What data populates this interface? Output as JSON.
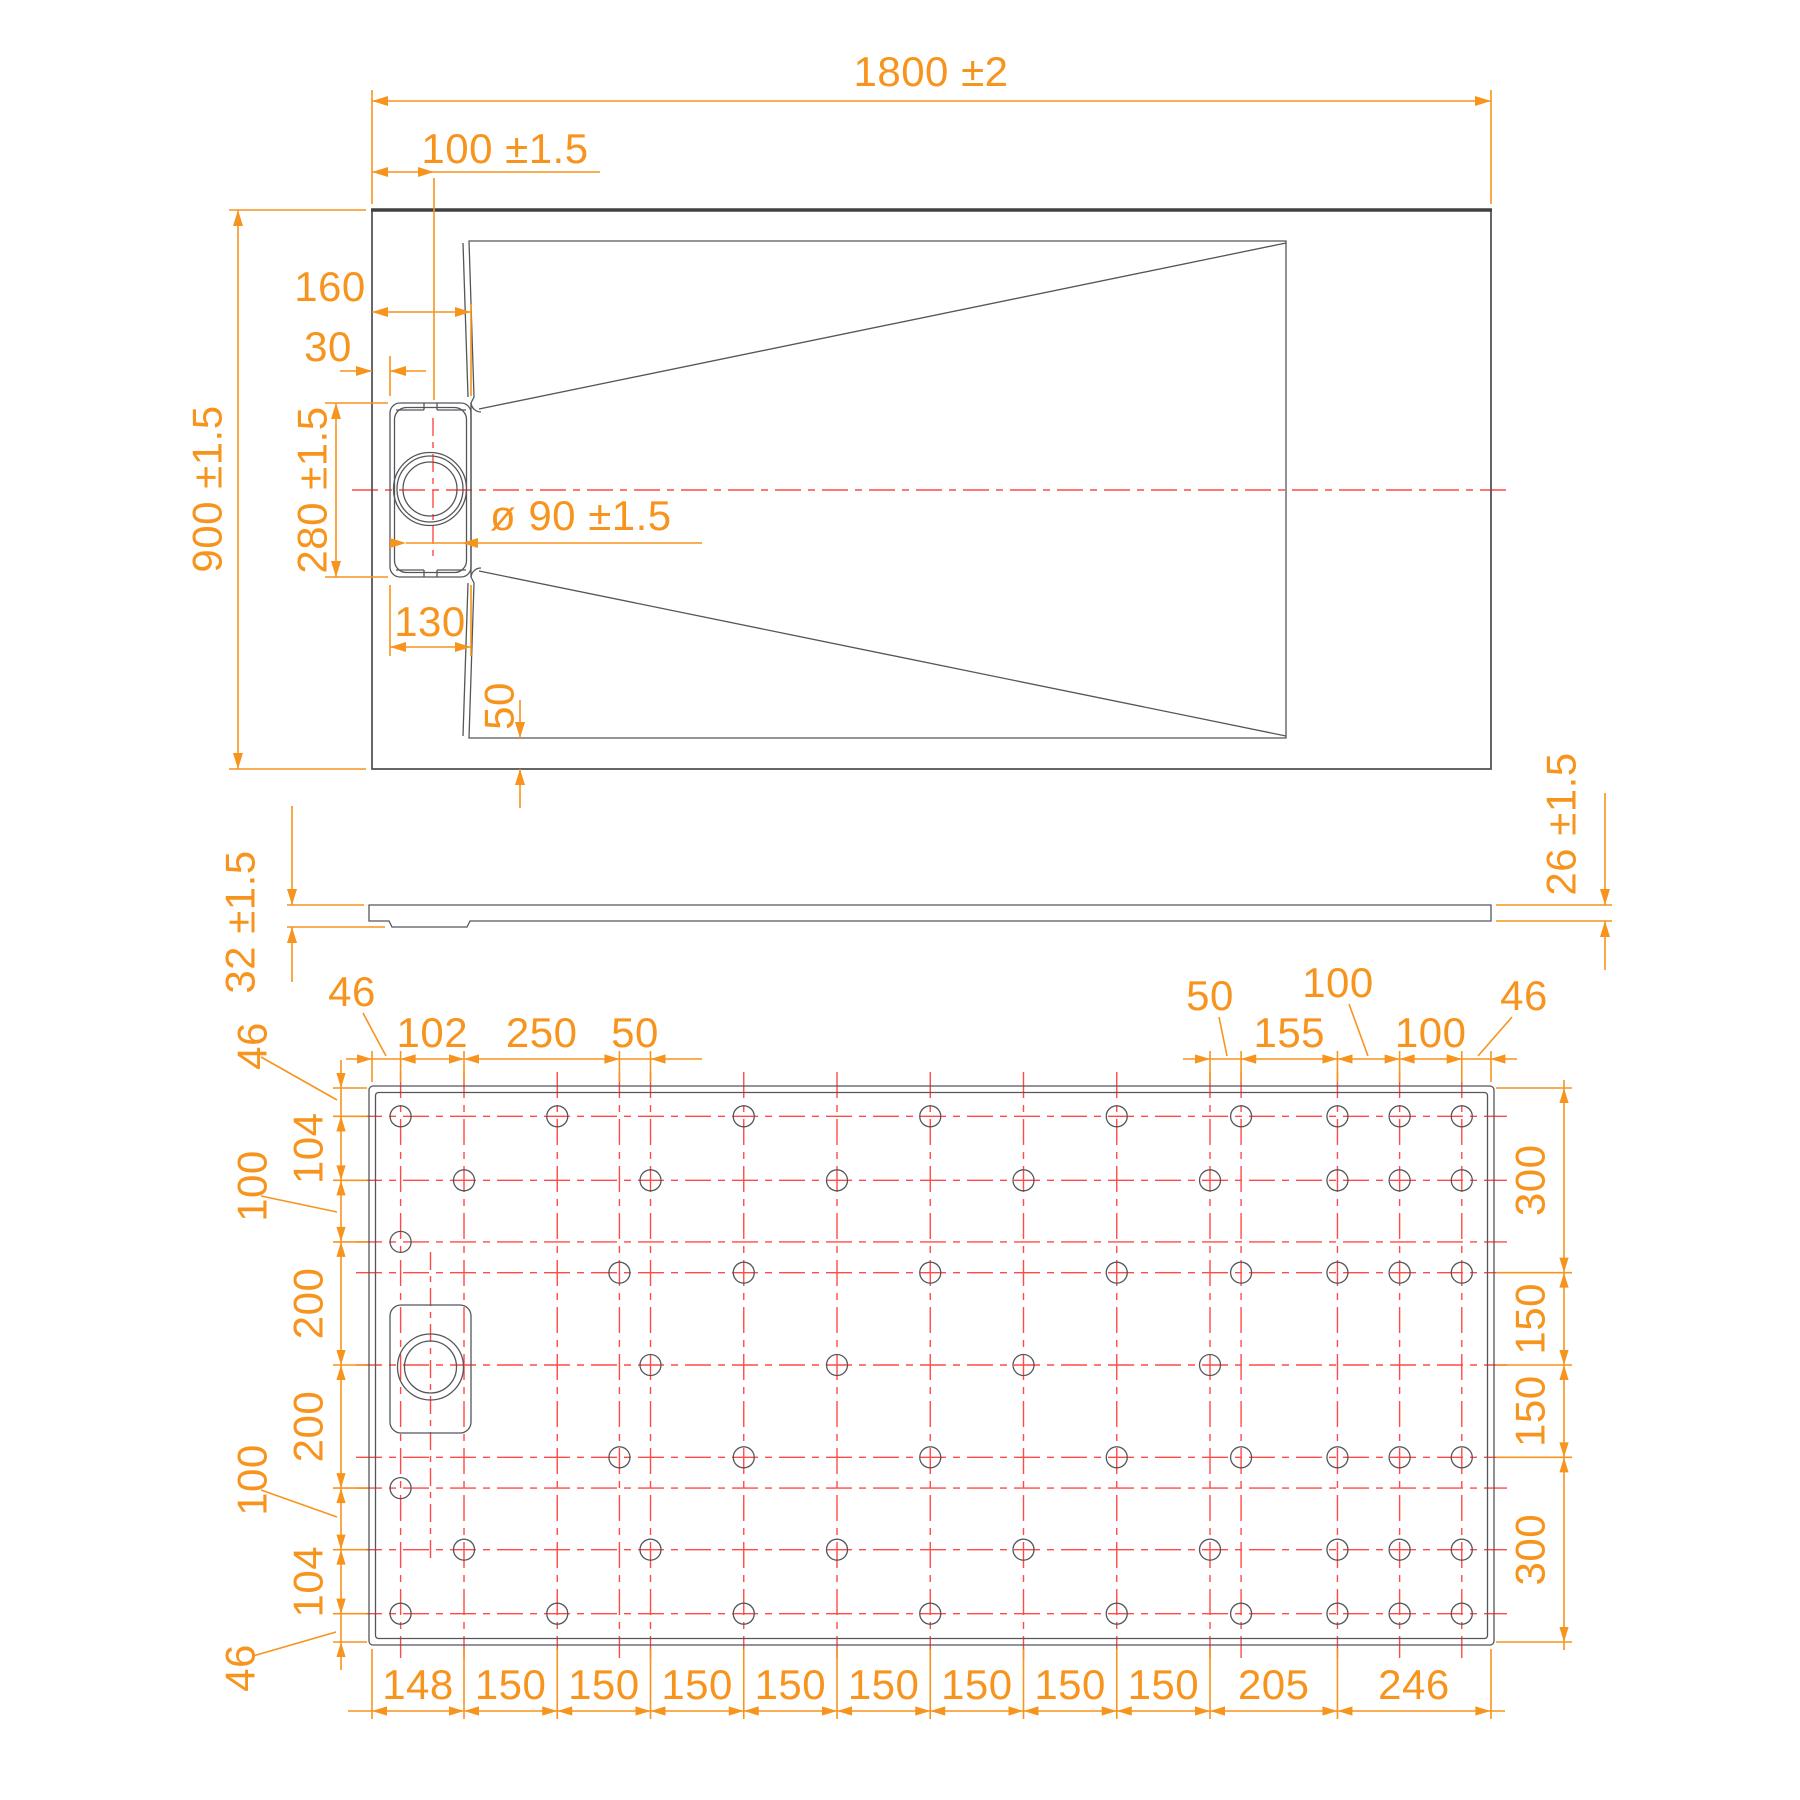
{
  "drawing": {
    "type": "shower tray technical drawing, three orthographic views",
    "colors": {
      "dimension": "#F7941E",
      "centerline": "#FF4A47",
      "outline": "#55565A",
      "background": "#FFFFFF"
    }
  },
  "top_view": {
    "overall_width_label": "1800 ±2",
    "overall_height_label": "900 ±1.5",
    "drain_center_offset_label": "100 ±1.5",
    "drain_right_edge_label": "160",
    "drain_side_gap_label": "30",
    "drain_channel_length_label": "280 ±1.5",
    "drain_hole_diameter_label": "ø 90 ±1.5",
    "drain_channel_width_label": "130",
    "floor_bottom_margin_label": "50"
  },
  "side_view": {
    "left_thickness_label": "32 ±1.5",
    "right_thickness_label": "26 ±1.5"
  },
  "bottom_view": {
    "top_left_chain": [
      "46",
      "102",
      "250",
      "50"
    ],
    "top_left_segments_mm": [
      46,
      102,
      250,
      50
    ],
    "top_right_chain": [
      "50",
      "155",
      "100",
      "100",
      "46"
    ],
    "top_right_segments_mm": [
      50,
      155,
      100,
      100,
      46
    ],
    "top_right_start_mm": 1348,
    "left_chain": [
      "46",
      "104",
      "100",
      "200",
      "200",
      "100",
      "104",
      "46"
    ],
    "left_segments_mm": [
      46,
      104,
      100,
      200,
      200,
      100,
      104,
      46
    ],
    "right_chain": [
      "300",
      "150",
      "150",
      "300"
    ],
    "right_segments_mm": [
      300,
      150,
      150,
      300
    ],
    "bottom_chain": [
      "148",
      "150",
      "150",
      "150",
      "150",
      "150",
      "150",
      "150",
      "150",
      "205",
      "246"
    ],
    "bottom_segments_mm": [
      148,
      150,
      150,
      150,
      150,
      150,
      150,
      150,
      150,
      205,
      246
    ],
    "hole_columns_mm": [
      46,
      148,
      298,
      398,
      448,
      598,
      748,
      898,
      1048,
      1198,
      1348,
      1398,
      1553,
      1653,
      1753
    ],
    "hole_rows_mm": [
      46,
      150,
      250,
      300,
      450,
      600,
      650,
      750,
      854
    ],
    "holes": [
      [
        46,
        46
      ],
      [
        46,
        250
      ],
      [
        46,
        650
      ],
      [
        46,
        854
      ],
      [
        148,
        150
      ],
      [
        148,
        750
      ],
      [
        298,
        46
      ],
      [
        298,
        854
      ],
      [
        398,
        300
      ],
      [
        398,
        600
      ],
      [
        448,
        150
      ],
      [
        448,
        450
      ],
      [
        448,
        750
      ],
      [
        598,
        46
      ],
      [
        598,
        300
      ],
      [
        598,
        600
      ],
      [
        598,
        854
      ],
      [
        748,
        150
      ],
      [
        748,
        450
      ],
      [
        748,
        750
      ],
      [
        898,
        46
      ],
      [
        898,
        300
      ],
      [
        898,
        600
      ],
      [
        898,
        854
      ],
      [
        1048,
        150
      ],
      [
        1048,
        450
      ],
      [
        1048,
        750
      ],
      [
        1198,
        46
      ],
      [
        1198,
        300
      ],
      [
        1198,
        600
      ],
      [
        1198,
        854
      ],
      [
        1348,
        150
      ],
      [
        1348,
        450
      ],
      [
        1348,
        750
      ],
      [
        1398,
        46
      ],
      [
        1398,
        300
      ],
      [
        1398,
        600
      ],
      [
        1398,
        854
      ],
      [
        1553,
        46
      ],
      [
        1553,
        150
      ],
      [
        1553,
        300
      ],
      [
        1553,
        600
      ],
      [
        1553,
        750
      ],
      [
        1553,
        854
      ],
      [
        1653,
        46
      ],
      [
        1653,
        150
      ],
      [
        1653,
        300
      ],
      [
        1653,
        600
      ],
      [
        1653,
        750
      ],
      [
        1653,
        854
      ],
      [
        1753,
        46
      ],
      [
        1753,
        150
      ],
      [
        1753,
        300
      ],
      [
        1753,
        600
      ],
      [
        1753,
        750
      ],
      [
        1753,
        854
      ]
    ]
  }
}
